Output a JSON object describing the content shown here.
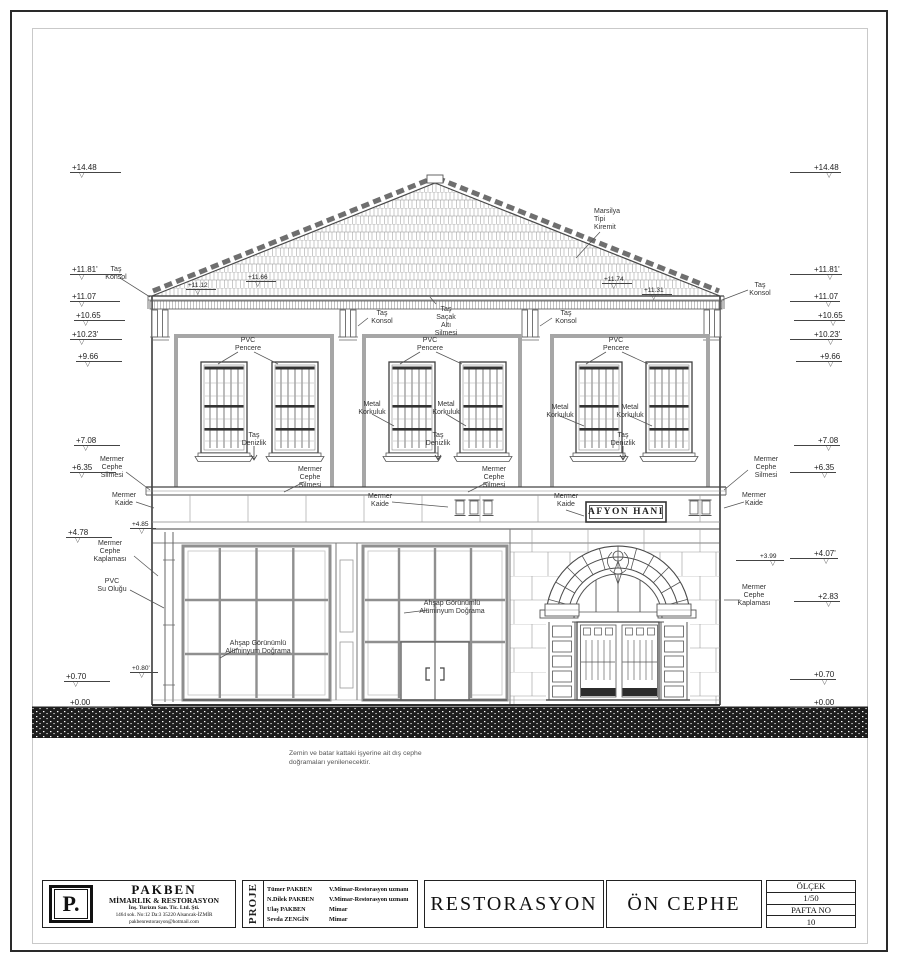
{
  "drawing": {
    "labels": {
      "tas_konsol": "Taş\nKonsol",
      "marsilya": "Marsilya\nTipi\nKiremit",
      "sacak": "Taş\nSaçak\nAltı\nSilmesi",
      "pvc_pencere": "PVC\nPencere",
      "metal_korkuluk": "Metal\nKorkuluk",
      "tas_denizlik": "Taş\nDenizlik",
      "mermer_cephe_silmesi": "Mermer\nCephe\nSilmesi",
      "mermer_kaide": "Mermer\nKaide",
      "mermer_cephe_kaplamasi": "Mermer\nCephe\nKaplaması",
      "pvc_su_olugu": "PVC\nSu Oluğu",
      "ahsap": "Ahşap Görünümlü\nAlüminyum Doğrama"
    },
    "sign": "AFYON HANI",
    "note": "Zemin ve batar kattaki işyerine ait dış cephe\ndoğramaları yenilenecektir.",
    "levels_left": [
      "+14.48",
      "+11.81'",
      "+11.07",
      "+10.65",
      "+10.23'",
      "+9.66",
      "+7.08",
      "+6.35",
      "+4.85",
      "+4.78",
      "+0.80'",
      "+0.70",
      "+0.00"
    ],
    "levels_right": [
      "+14.48",
      "+11.81'",
      "+11.07",
      "+10.65",
      "+10.23'",
      "+9.66",
      "+7.08",
      "+6.35",
      "+4.07'",
      "+3.99",
      "+2.83",
      "+0.70",
      "+0.00"
    ],
    "eave_levels": [
      "+11.66",
      "+11.12",
      "+11.74",
      "+11.31"
    ]
  },
  "titleblock": {
    "company": {
      "logo": "P.",
      "name": "PAKBEN",
      "subtitle": "MİMARLIK & RESTORASYON",
      "line1": "İnş. Turizm San. Tic. Ltd. Şti.",
      "line2": "1464 sok. No:12 Da:3 35220 Alsancak-İZMİR",
      "line3": "pakbenrestorasyon@hotmail.com"
    },
    "proje_label": "PROJE",
    "team": [
      {
        "name": "Tümer PAKBEN",
        "role": "V.Mimar-Restorasyon uzmanı"
      },
      {
        "name": "N.Dilek PAKBEN",
        "role": "V.Mimar-Restorasyon uzmanı"
      },
      {
        "name": "Ulaş PAKBEN",
        "role": "Mimar"
      },
      {
        "name": "Sevda ZENGİN",
        "role": "Mimar"
      }
    ],
    "project_type": "RESTORASYON",
    "drawing_title": "ÖN CEPHE",
    "scale_label": "ÖLÇEK",
    "scale_value": "1/50",
    "sheet_label": "PAFTA NO",
    "sheet_value": "10"
  }
}
